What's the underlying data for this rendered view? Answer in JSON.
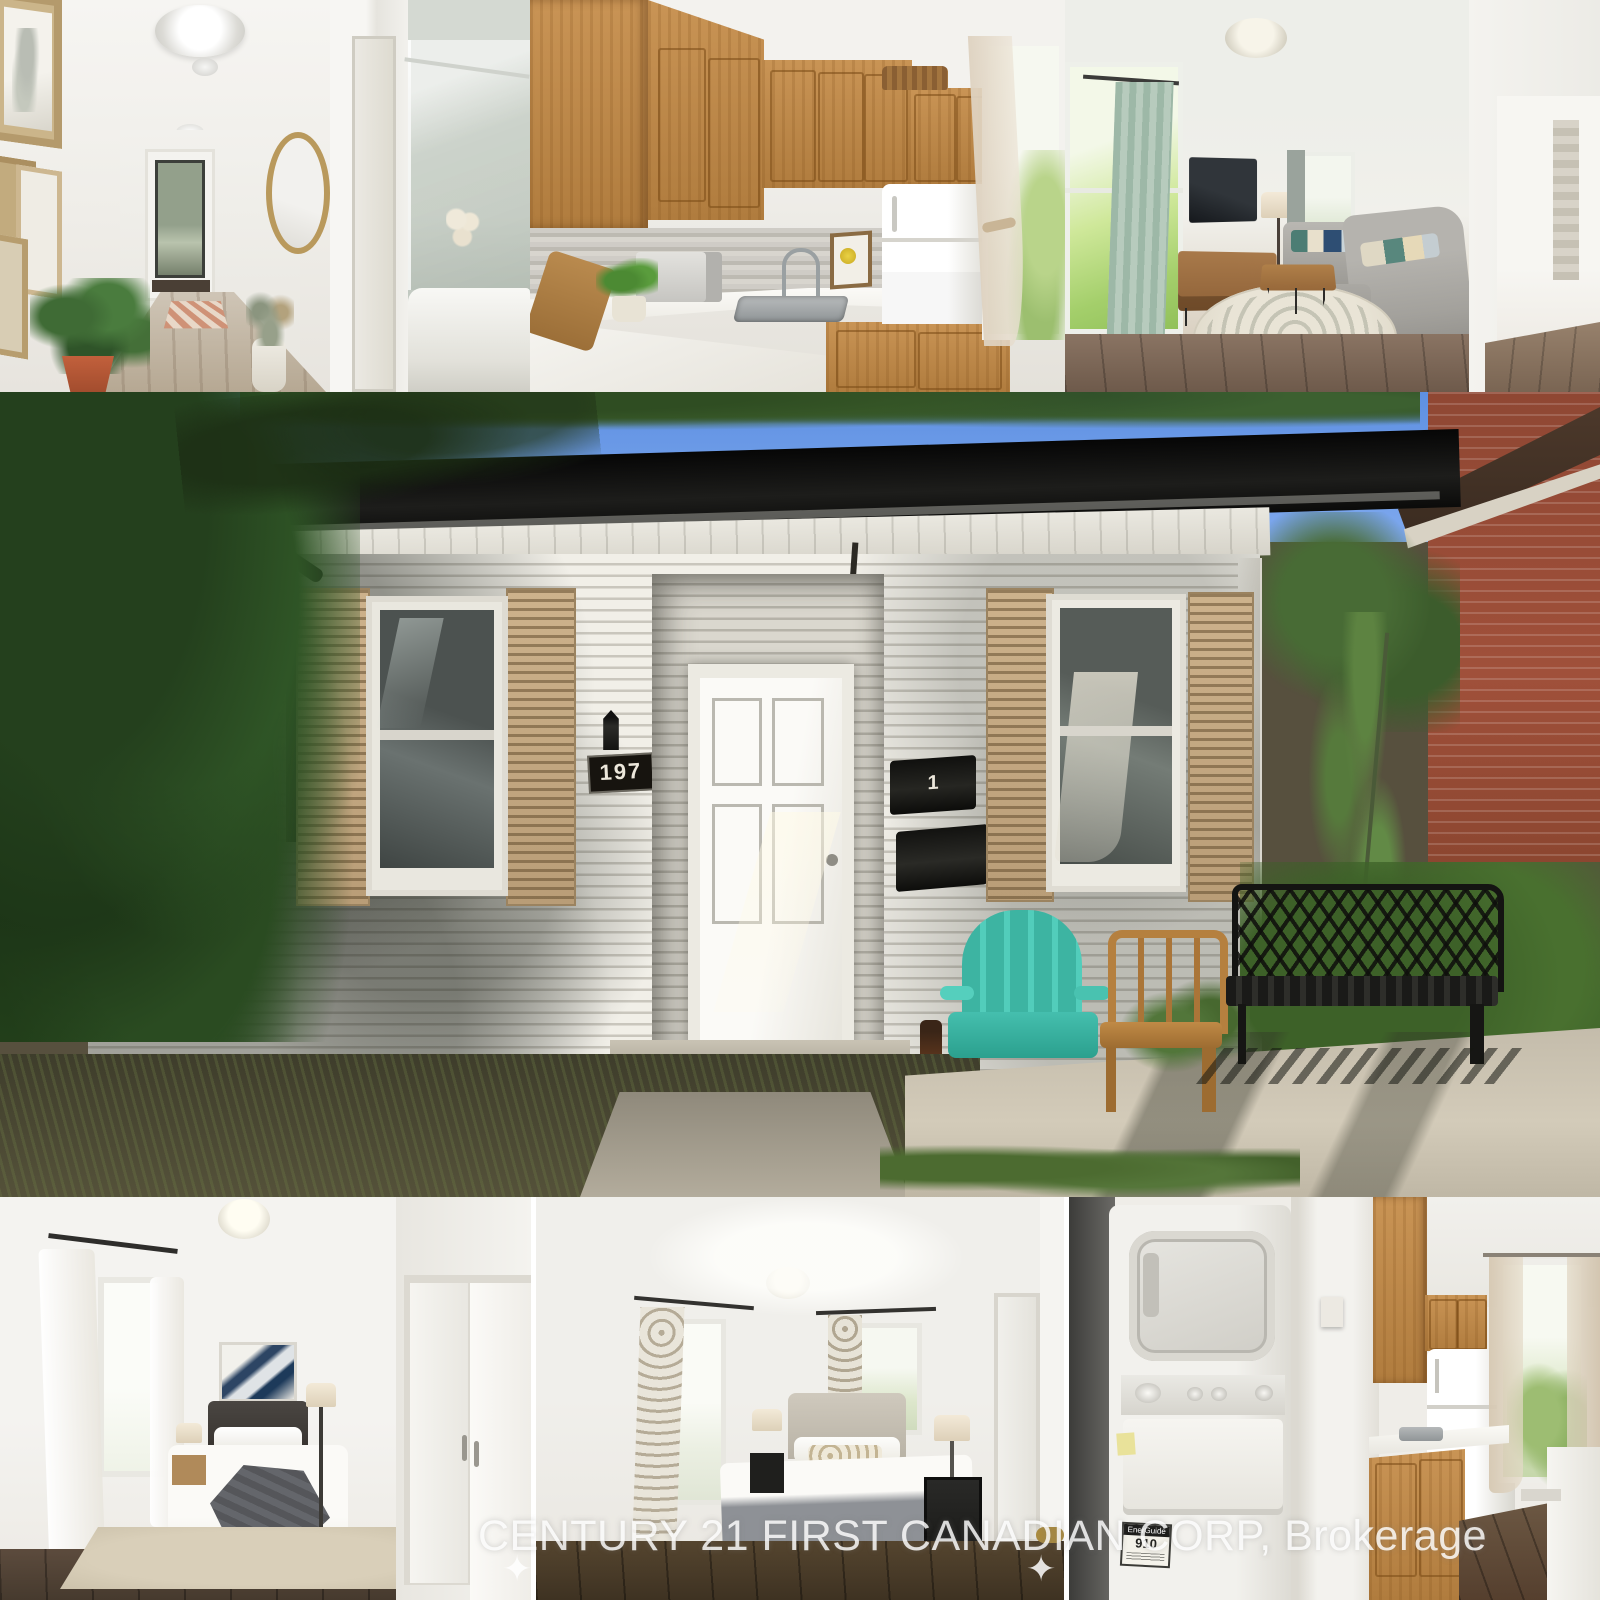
{
  "collage": {
    "watermark": {
      "text": "CENTURY 21 FIRST CANADIAN CORP, Brokerage",
      "sparkle": "✦"
    },
    "exterior": {
      "house_number": "197",
      "mailbox_number": "1"
    },
    "laundry": {
      "energy_label": "EnerGuide",
      "energy_number": "910"
    },
    "colors": {
      "sky": "#6f9ce8",
      "siding_white": "#f1efe8",
      "fascia_black": "#131311",
      "shutter_tan": "#c4a980",
      "adirondack_teal": "#46c2b0",
      "wood_chair": "#b97f3f",
      "bench_black": "#1c1c1a",
      "oak_cabinet": "#c28a49",
      "brick_red": "#9e4a33",
      "watermark_white": "#ffffff"
    }
  }
}
